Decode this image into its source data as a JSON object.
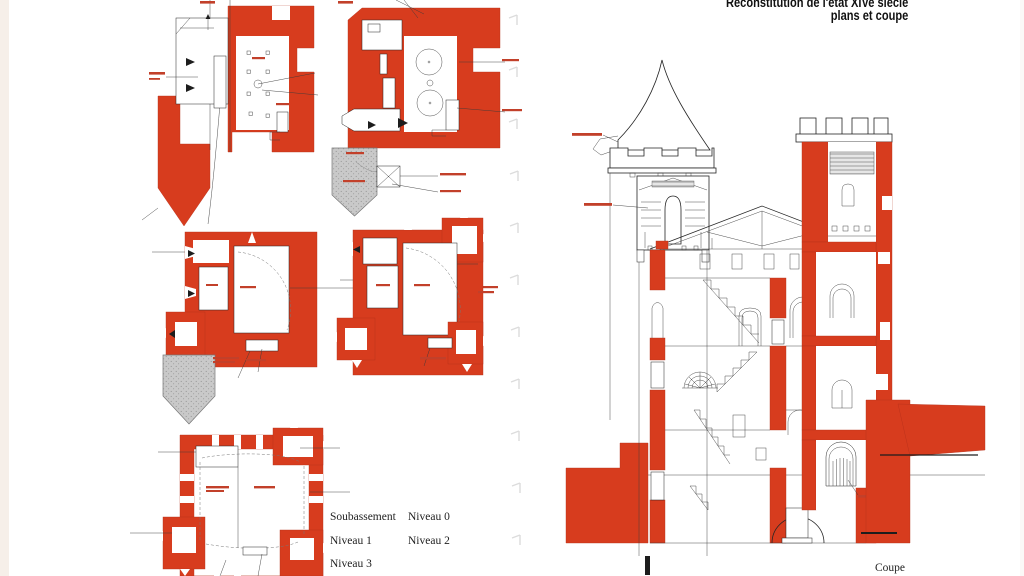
{
  "figure": {
    "title_line1": "Reconstitution de l'état XIVe siècle",
    "title_line2": "plans et coupe",
    "section_caption": "Coupe",
    "legend": {
      "col1": [
        "Soubassement",
        "Niveau 1",
        "Niveau 3"
      ],
      "col2": [
        "Niveau 0",
        "Niveau 2"
      ]
    },
    "plans": [
      {
        "id": "soubassement",
        "label": "Soubassement"
      },
      {
        "id": "niveau-0",
        "label": "Niveau 0"
      },
      {
        "id": "niveau-1",
        "label": "Niveau 1"
      },
      {
        "id": "niveau-2",
        "label": "Niveau 2"
      },
      {
        "id": "niveau-3",
        "label": "Niveau 3"
      }
    ],
    "colors": {
      "masonry_red": "#d73c1e",
      "ditch_gray": "#c9c9c9",
      "line_black": "#1d1d1d",
      "page_white": "#ffffff",
      "margin_strip": "#f6efe9"
    }
  }
}
